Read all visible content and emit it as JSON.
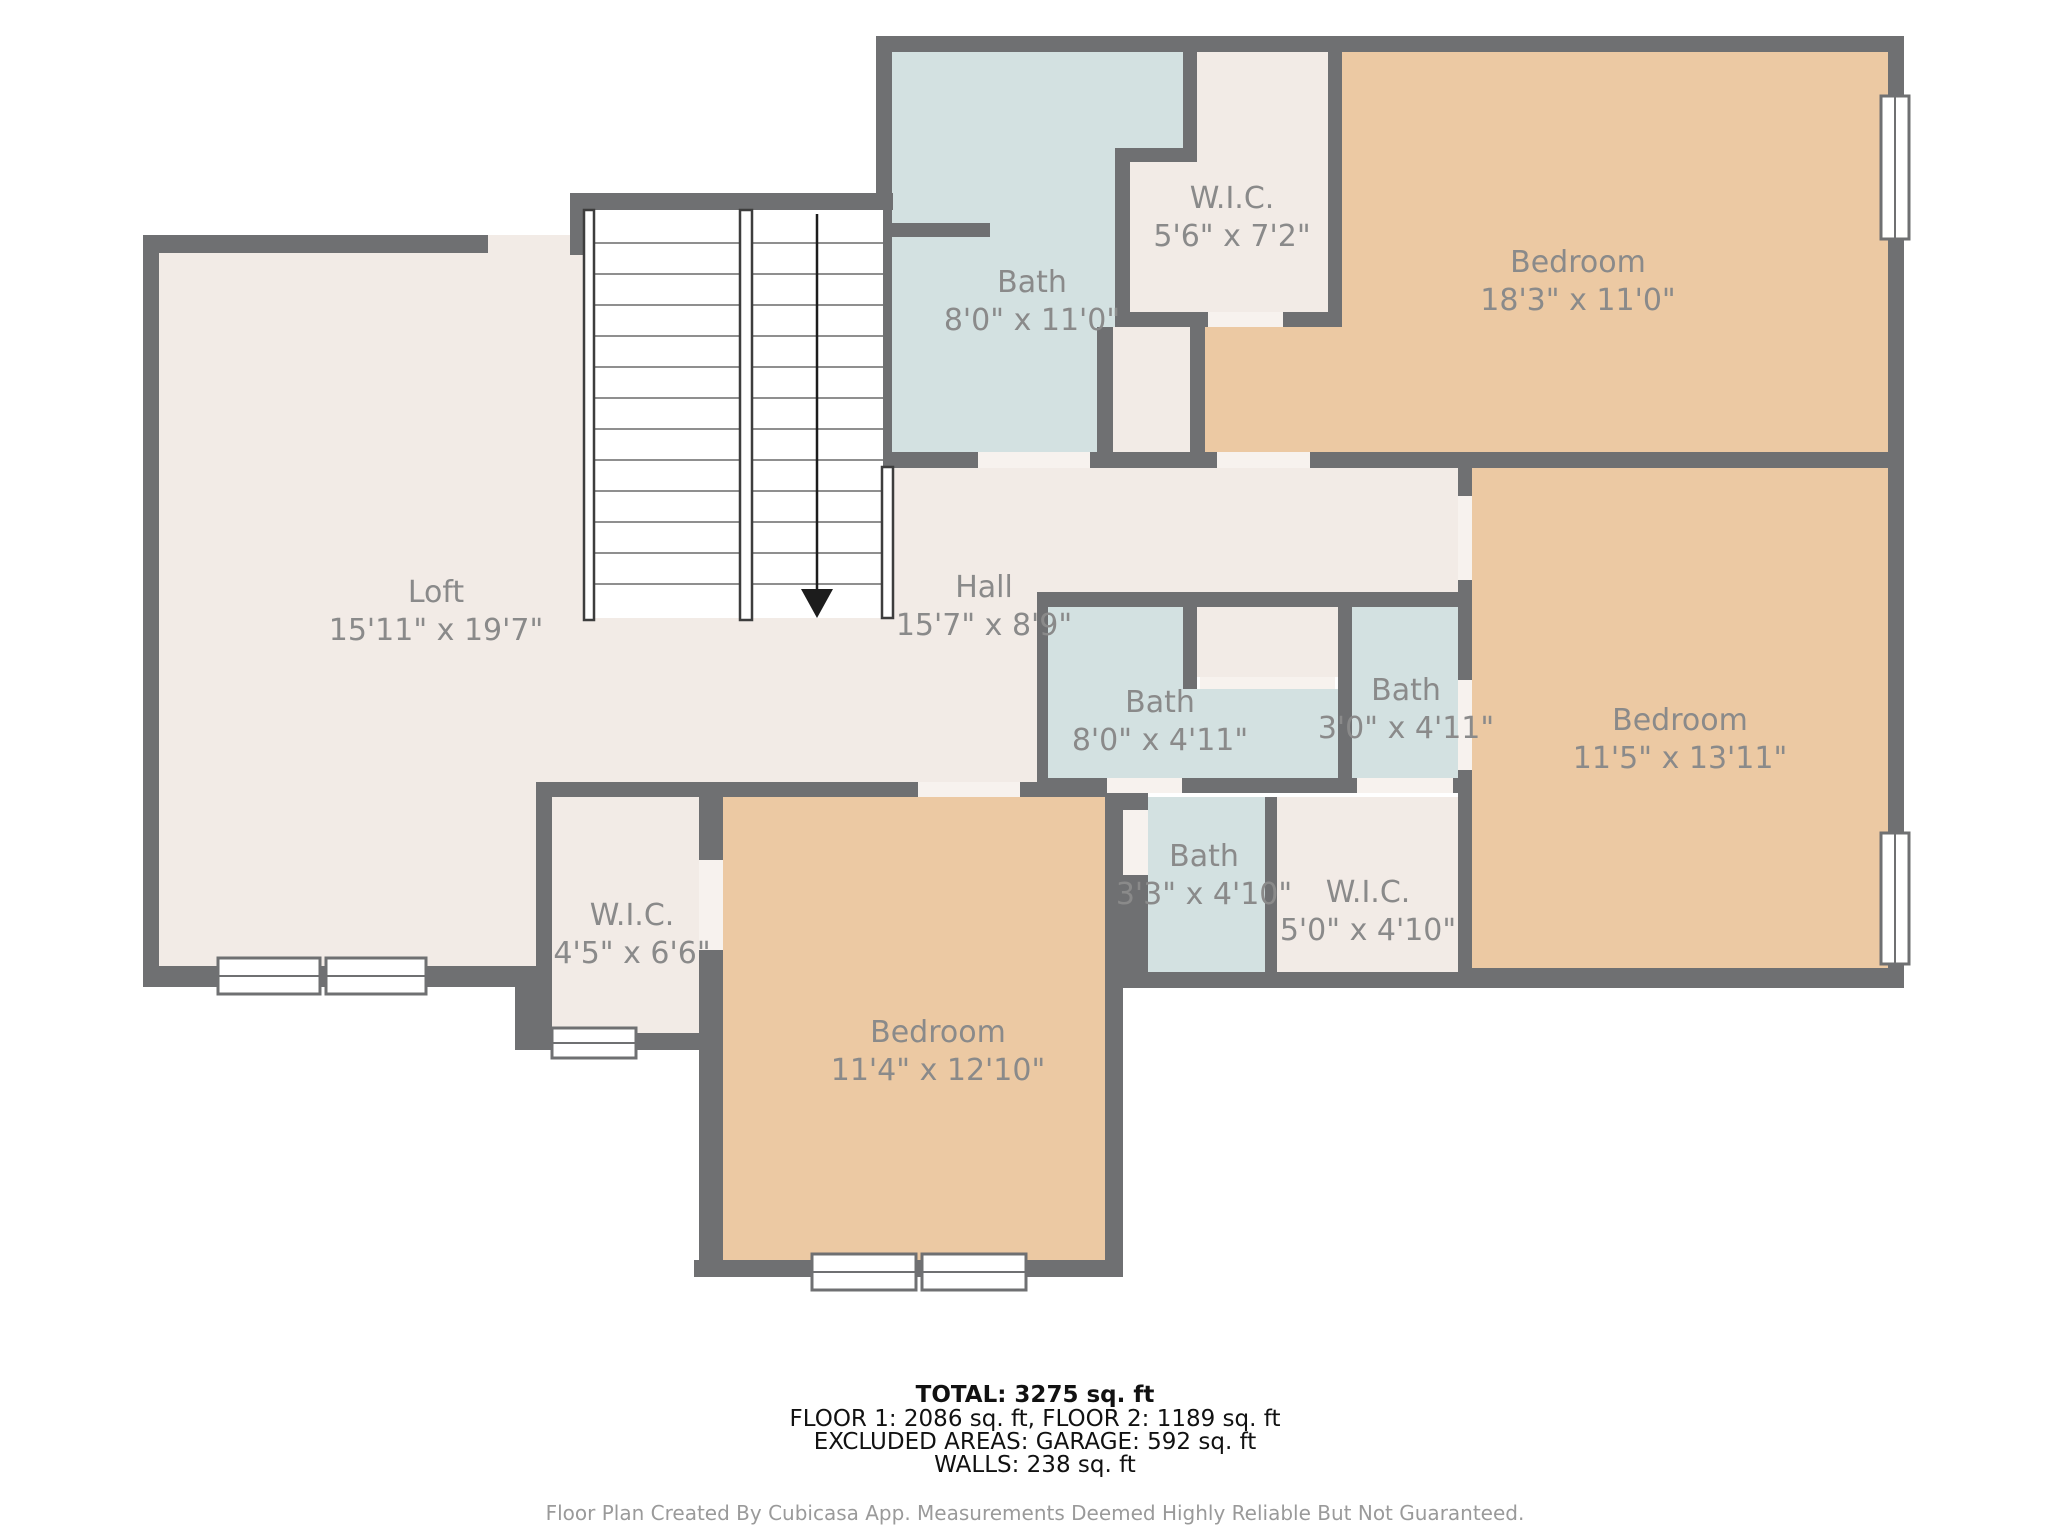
{
  "rooms": [
    {
      "id": "bath-upper",
      "name": "Bath",
      "dims": "8'0\" x 11'0\""
    },
    {
      "id": "wic-upper",
      "name": "W.I.C.",
      "dims": "5'6\" x 7'2\""
    },
    {
      "id": "bedroom-upper",
      "name": "Bedroom",
      "dims": "18'3\" x 11'0\""
    },
    {
      "id": "loft",
      "name": "Loft",
      "dims": "15'11\" x 19'7\""
    },
    {
      "id": "hall",
      "name": "Hall",
      "dims": "15'7\" x 8'9\""
    },
    {
      "id": "bath-middle",
      "name": "Bath",
      "dims": "8'0\" x 4'11\""
    },
    {
      "id": "bath-small",
      "name": "Bath",
      "dims": "3'0\" x 4'11\""
    },
    {
      "id": "bedroom-right",
      "name": "Bedroom",
      "dims": "11'5\" x 13'11\""
    },
    {
      "id": "wic-left",
      "name": "W.I.C.",
      "dims": "4'5\" x 6'6\""
    },
    {
      "id": "bath-lower",
      "name": "Bath",
      "dims": "3'3\" x 4'10\""
    },
    {
      "id": "wic-right",
      "name": "W.I.C.",
      "dims": "5'0\" x 4'10\""
    },
    {
      "id": "bedroom-bottom",
      "name": "Bedroom",
      "dims": "11'4\" x 12'10\""
    }
  ],
  "summary": {
    "total": "TOTAL: 3275 sq. ft",
    "floors": "FLOOR 1: 2086 sq. ft, FLOOR 2: 1189 sq. ft",
    "excluded": "EXCLUDED AREAS: GARAGE: 592 sq. ft",
    "walls": "WALLS: 238 sq. ft",
    "disclaimer": "Floor Plan Created By Cubicasa App. Measurements Deemed Highly Reliable But Not Guaranteed."
  },
  "colors": {
    "wall": "#6f7072",
    "room_default": "#f2ebe6",
    "bath": "#d3e1e1",
    "bedroom": "#ecc9a3",
    "label": "#8a8a8a"
  }
}
